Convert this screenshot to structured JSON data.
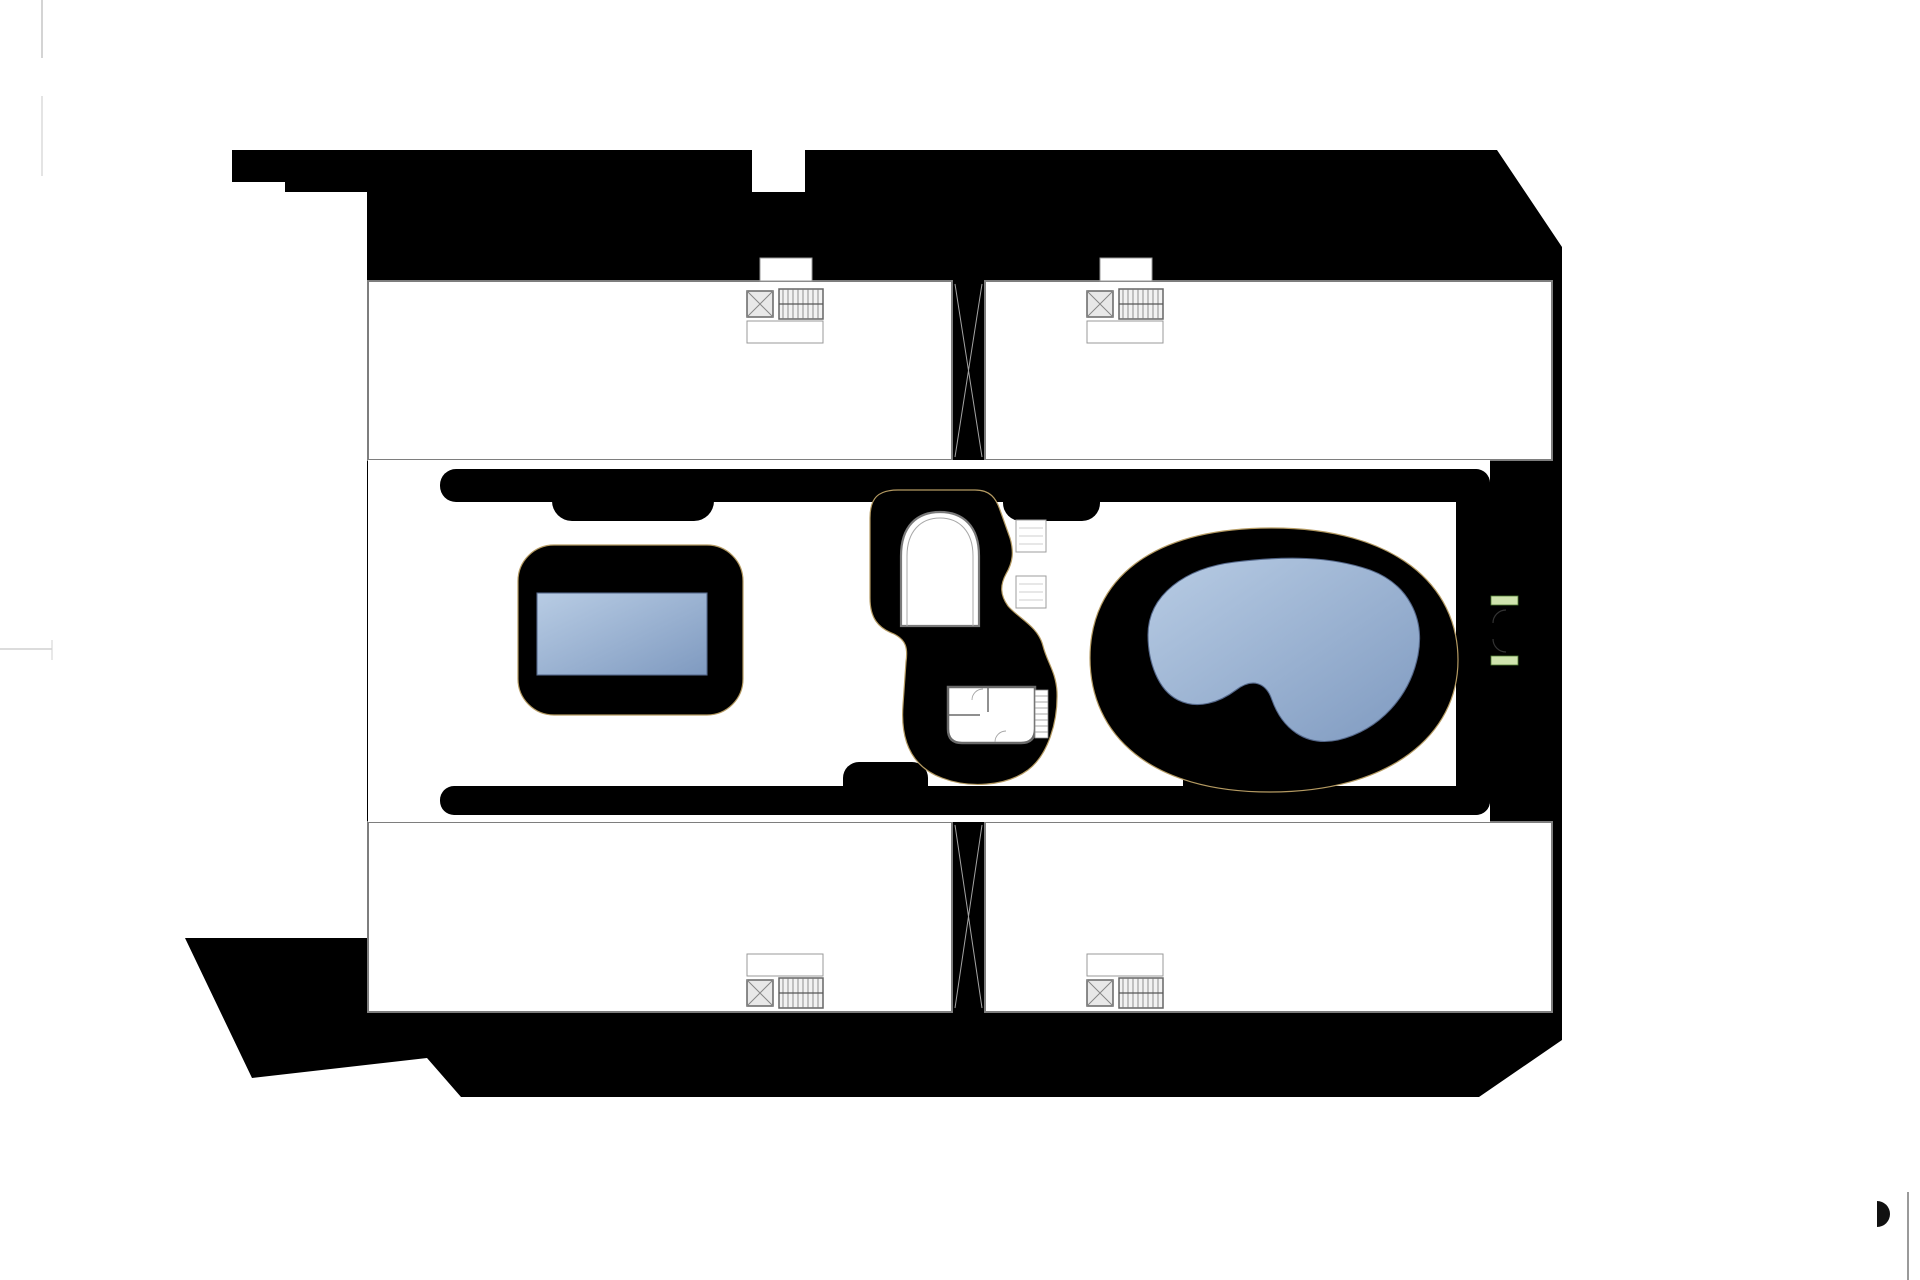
{
  "plan": {
    "blocks": {
      "a": "BLOQUE A",
      "b": "BLOQUE B",
      "c": "BLOQUE C",
      "d": "BLOQUE D"
    },
    "parking": {
      "top_left": [
        "P72",
        "P71",
        "P70",
        "P69",
        "P68",
        "P67",
        "P66",
        "P65",
        "P64",
        "P63",
        "P62",
        "P61",
        {
          "label": "P60",
          "accessible": true
        }
      ],
      "top_mid_d": [
        "P59",
        "P58",
        "P57",
        "P56",
        "P55"
      ],
      "top_mid_c": [
        "P54",
        "P53",
        "P52",
        "P51"
      ],
      "top_right": [
        "P50",
        "P49",
        "P48",
        "P47",
        "P46",
        "P45",
        "P44",
        "P43",
        "P42",
        "P41",
        "P40"
      ],
      "right_upper": [
        "P39",
        "P38",
        "P37",
        "P36",
        "P35"
      ],
      "right_lower": [
        "P34",
        "P33",
        "P32",
        "P31",
        "P30"
      ],
      "bottom_left": [
        "P1",
        "P2",
        "P3",
        "P4",
        "P5",
        "P6",
        "P7",
        "P8",
        "P9",
        "P10"
      ],
      "bottom_mid_a": [
        "P11",
        "P12",
        "P13",
        "P14",
        "P15"
      ],
      "bottom_mid_b": [
        {
          "label": "P16",
          "accessible": true
        },
        "P17",
        "P18",
        "P19"
      ],
      "bottom_right": [
        "P20",
        "P21",
        "P22",
        "P23",
        "P24",
        "P25",
        "P26",
        "P27",
        "P28",
        "P29"
      ]
    },
    "units": {
      "top_left": [
        "55",
        "56",
        "57",
        "58",
        "59",
        "60"
      ],
      "top_right": [
        "42",
        "41",
        "40",
        "39",
        "38",
        "37"
      ],
      "bottom_left": [
        "1",
        "2",
        "3",
        "4",
        "5",
        "6"
      ],
      "bottom_right": [
        "24",
        "23",
        "22",
        "21",
        "20",
        "19"
      ]
    },
    "disclaimer": "El promotor se reserva el derecho a introducir modificaciones por necesidad de índole técnica o legal",
    "icons": {
      "accessible": "wheelchair-icon"
    },
    "colors": {
      "walkway_pink": "#f2a8a1",
      "deck_tan": "#f6dca6",
      "pool_blue_light": "#b8cce4",
      "pool_blue_dark": "#7f9ac0",
      "paving_gray": "#e5e5e5",
      "stall_gray": "#b9b9b9",
      "stall_gray_dark": "#b1b1b1"
    }
  }
}
